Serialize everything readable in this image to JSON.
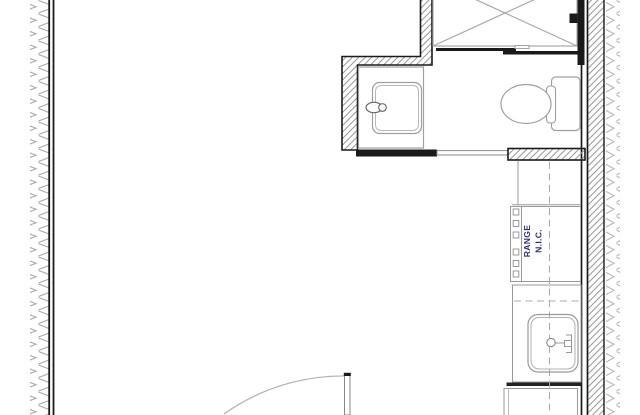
{
  "plan": {
    "name": "partial-floor-plan",
    "labels": {
      "range_line1": "RANGE",
      "range_line2": "N.I.C."
    },
    "colors": {
      "wall_line": "#1a1a1a",
      "wall_hatch": "#9a9a9a",
      "insulation_chevron": "#a8a8a8",
      "fixture_line": "#a0a0a0",
      "counter_line": "#999999",
      "dashed_line": "#ababab",
      "label_text": "#2b2b8c",
      "bold_counter_edge": "#222222",
      "background": "#ffffff"
    },
    "fixtures": [
      {
        "name": "shower"
      },
      {
        "name": "vanity-sink"
      },
      {
        "name": "toilet"
      },
      {
        "name": "pocket-door"
      },
      {
        "name": "counter-section"
      },
      {
        "name": "range"
      },
      {
        "name": "kitchen-sink"
      },
      {
        "name": "base-cabinet"
      },
      {
        "name": "swing-door"
      }
    ]
  }
}
